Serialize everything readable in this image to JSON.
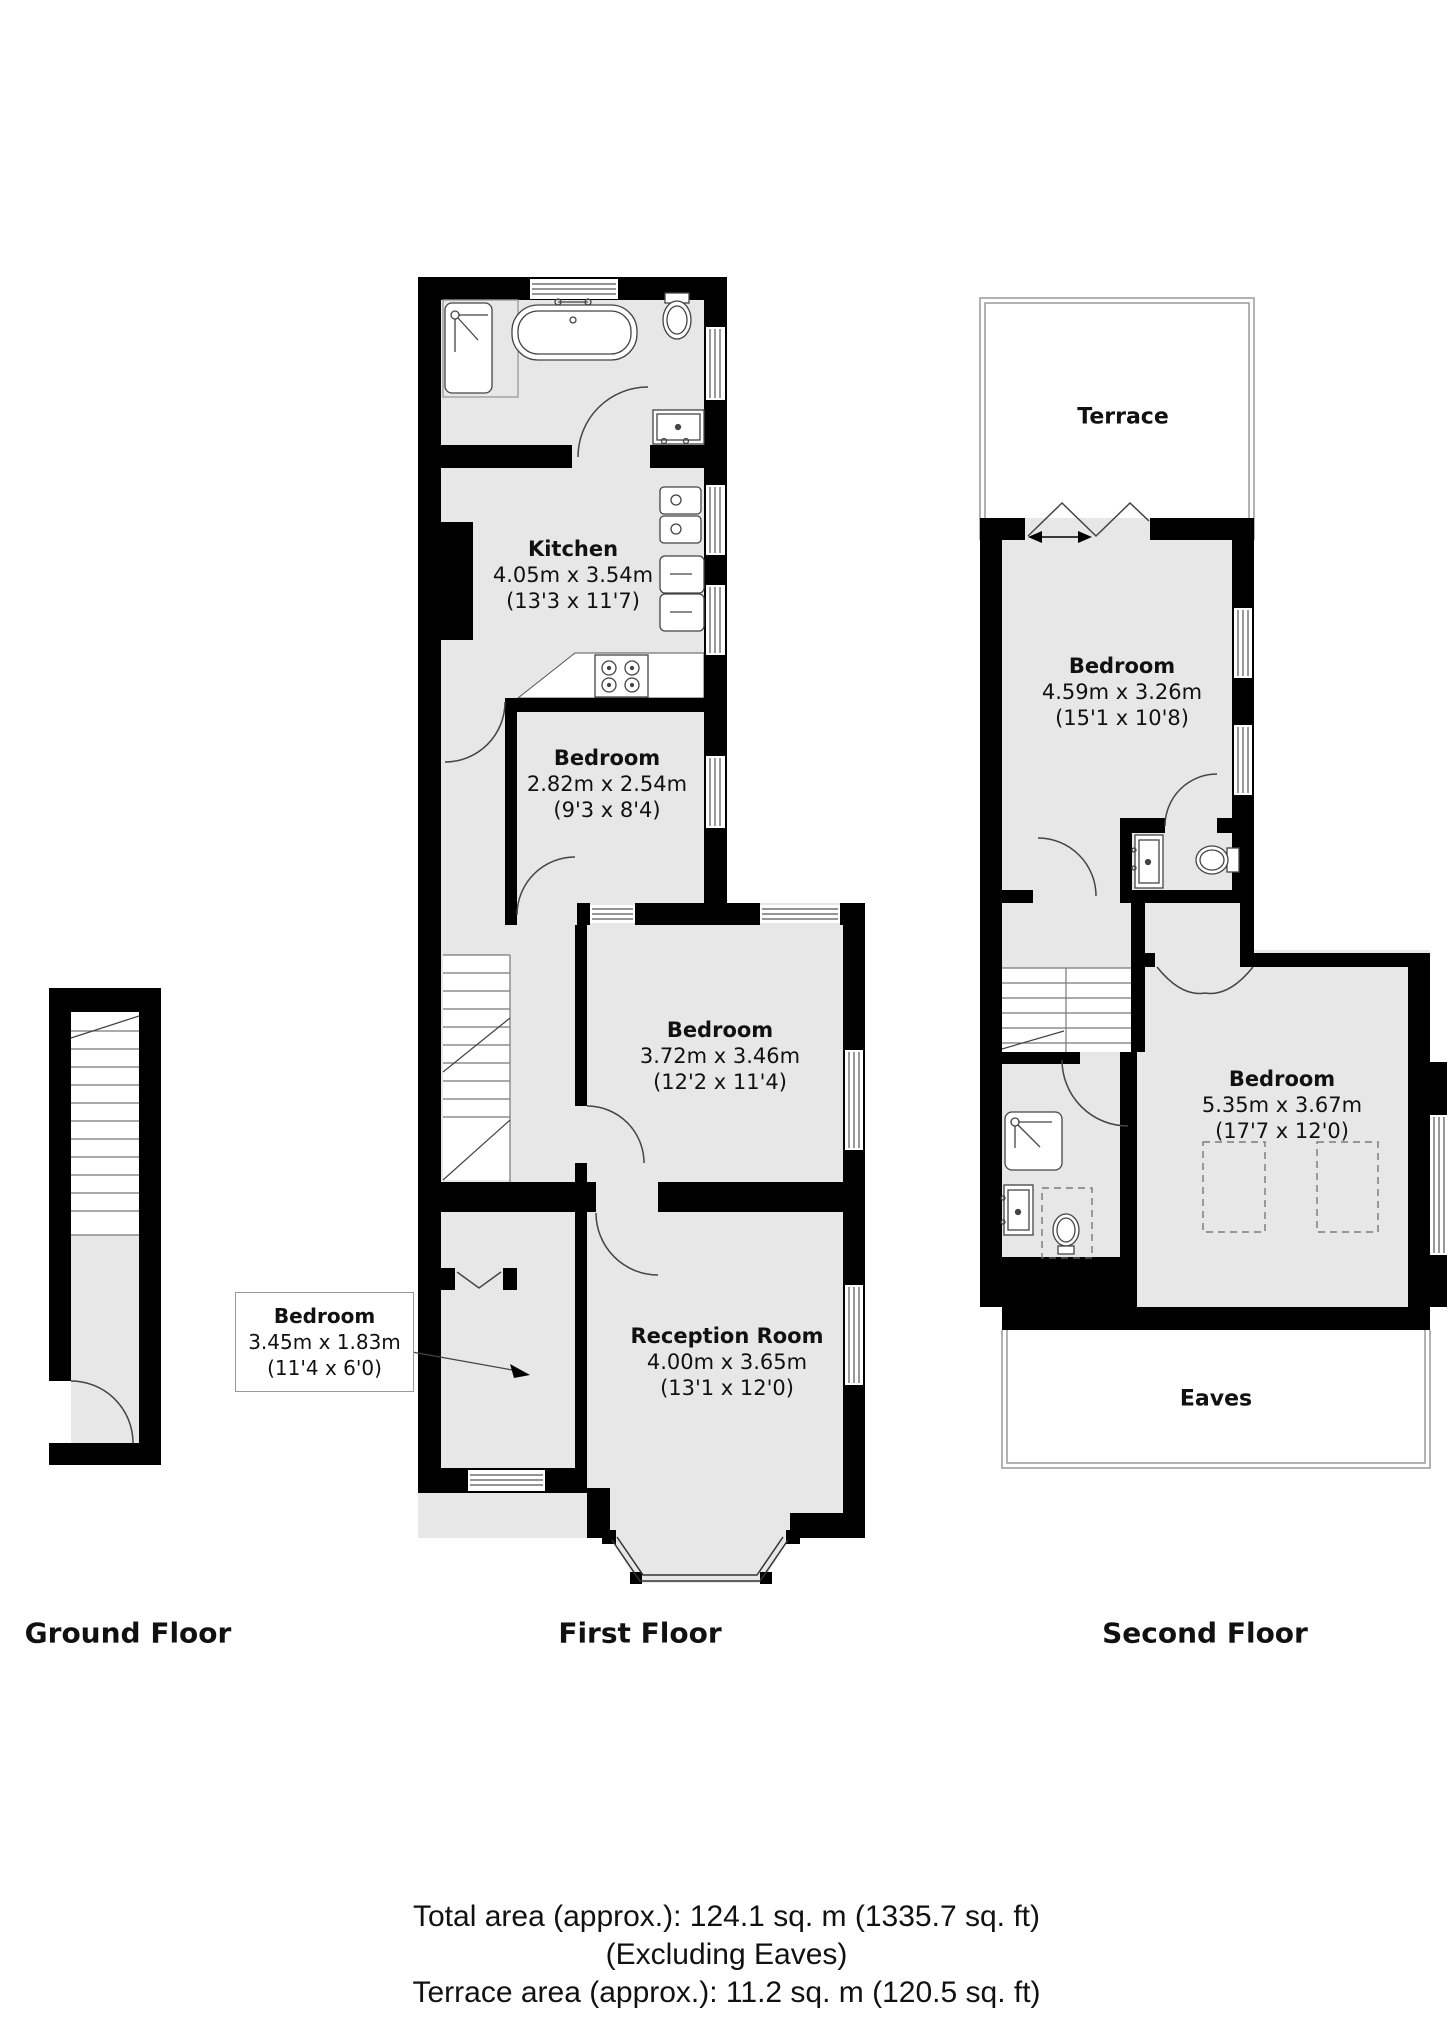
{
  "rooms": {
    "kitchen": {
      "name": "Kitchen",
      "metric": "4.05m x 3.54m",
      "imperial": "(13'3 x 11'7)"
    },
    "bedroom_small": {
      "name": "Bedroom",
      "metric": "2.82m x 2.54m",
      "imperial": "(9'3 x 8'4)"
    },
    "bedroom_middle": {
      "name": "Bedroom",
      "metric": "3.72m x 3.46m",
      "imperial": "(12'2 x 11'4)"
    },
    "bedroom_narrow": {
      "name": "Bedroom",
      "metric": "3.45m x 1.83m",
      "imperial": "(11'4 x 6'0)"
    },
    "reception": {
      "name": "Reception Room",
      "metric": "4.00m x 3.65m",
      "imperial": "(13'1 x 12'0)"
    },
    "bedroom_top2f": {
      "name": "Bedroom",
      "metric": "4.59m x 3.26m",
      "imperial": "(15'1 x 10'8)"
    },
    "bedroom_big2f": {
      "name": "Bedroom",
      "metric": "5.35m x 3.67m",
      "imperial": "(17'7 x 12'0)"
    },
    "terrace": {
      "name": "Terrace"
    },
    "eaves": {
      "name": "Eaves"
    }
  },
  "floors": {
    "ground": "Ground Floor",
    "first": "First Floor",
    "second": "Second Floor"
  },
  "summary": {
    "total_area": "Total area (approx.): 124.1 sq. m (1335.7 sq. ft)",
    "excluding": "(Excluding Eaves)",
    "terrace_area": "Terrace area (approx.): 11.2 sq. m (120.5 sq. ft)"
  },
  "colors": {
    "wall": "#000000",
    "room_fill": "#e7e7e7",
    "fixture_line": "#444444",
    "thin_outline": "#999999",
    "text": "#111111"
  }
}
